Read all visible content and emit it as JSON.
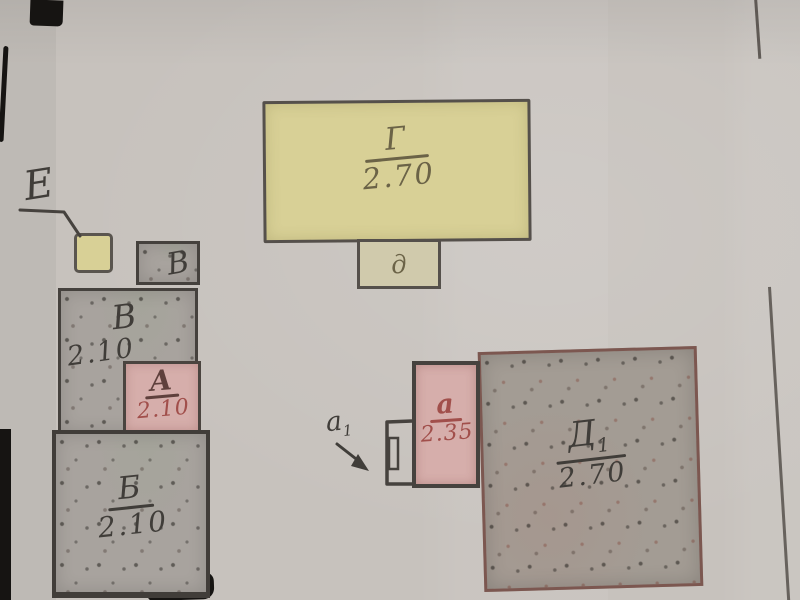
{
  "meta": {
    "description": "Hand-drawn building plan sketch, photographed page with labeled colored blocks"
  },
  "colors": {
    "paper": "#c7c2bd",
    "yellow_fill": "#d8d096",
    "pale_fill": "#d0caac",
    "gray_fill": "#a8a39e",
    "gray_fill_warm": "#a39c94",
    "pink_fill": "#d6aeab",
    "ink_dark": "#403d39",
    "ink_olive": "#6b6347",
    "ink_red": "#a14f4b",
    "ink_maroon": "#5f403c",
    "border_dark": "#4f4a45",
    "border_red": "#7c5750",
    "edge_line": "#4d4843",
    "black_mark": "#161412"
  },
  "blocks": {
    "g": {
      "letter": "Г",
      "value": "2.70"
    },
    "d_small": {
      "letter": "д"
    },
    "e_marker": {
      "letter": "Е"
    },
    "v_small": {
      "letter": "В"
    },
    "v": {
      "letter": "В",
      "value": "2.10"
    },
    "a_pink": {
      "letter": "А",
      "value": "2.10"
    },
    "b": {
      "letter": "Б",
      "value": "2.10"
    },
    "d1": {
      "letter": "Д",
      "sub": "1",
      "value": "2.70"
    },
    "a_annex": {
      "letter": "а",
      "value": "2.35"
    },
    "a1_entry": {
      "letter": "а",
      "sub": "1"
    }
  }
}
